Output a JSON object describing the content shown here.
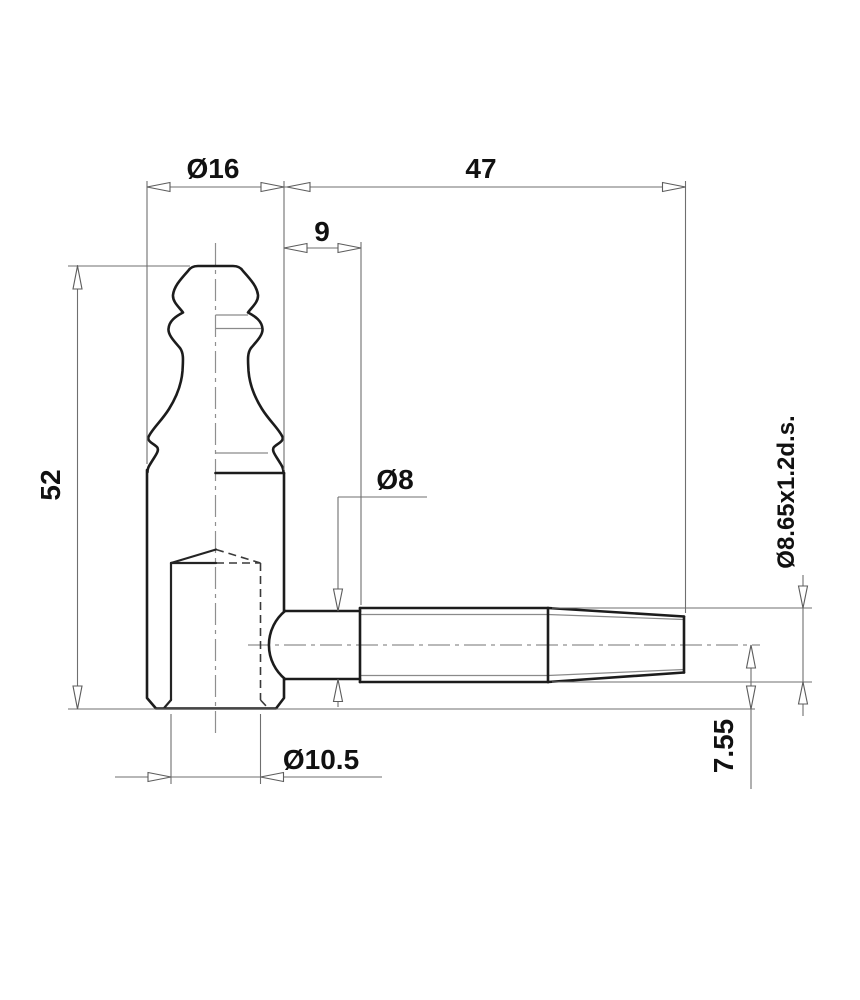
{
  "drawing": {
    "title": "hinge-pin technical drawing",
    "colors": {
      "background": "#ffffff",
      "outline": "#1c1c1c",
      "dimension_lines": "#6f6f6f",
      "text": "#111111"
    },
    "dimensions": {
      "knuckle_diameter": "Ø16",
      "pin_total_length": "47",
      "pin_plain_length": "9",
      "body_height": "52",
      "pin_diameter": "Ø8",
      "thread_spec": "Ø8.65x1.2d.s.",
      "bore_diameter": "Ø10.5",
      "axis_offset": "7.55"
    }
  }
}
